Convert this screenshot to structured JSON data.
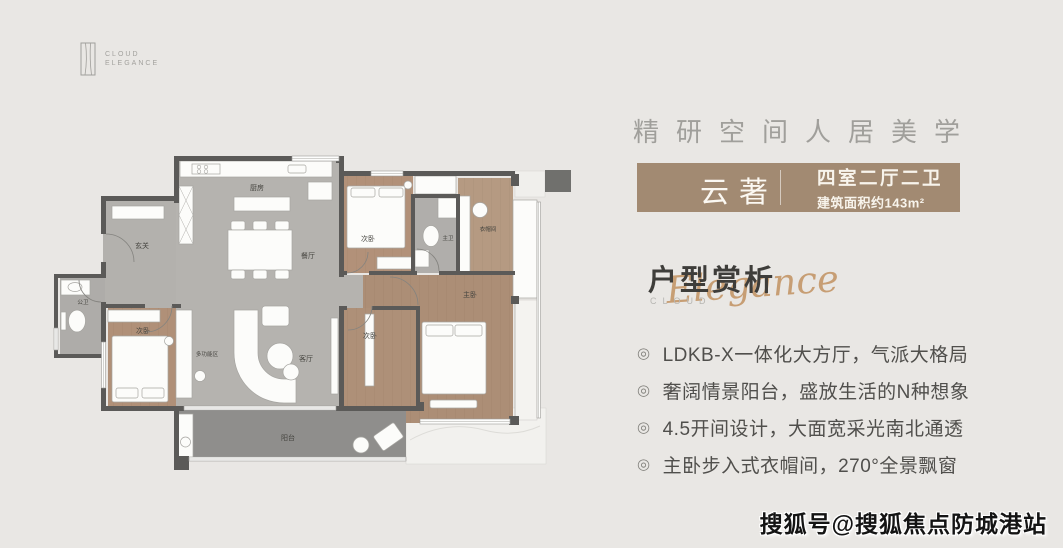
{
  "logo": {
    "line1": "CLOUD",
    "line2": "ELEGANCE"
  },
  "tagline": "精研空间人居美学",
  "badge": {
    "name": "云著",
    "layout": "四室二厅二卫",
    "area": "建筑面积约143m²",
    "bg_color": "#a28a72"
  },
  "section": {
    "title": "户型赏析",
    "eyebrow": "CLOUD",
    "script": "Elegance",
    "script_color": "#c79e74"
  },
  "bullet_icon": "◎",
  "features": [
    "LDKB-X一体化大方厅，气派大格局",
    "奢阔情景阳台，盛放生活的N种想象",
    "4.5开间设计，大面宽采光南北通透",
    "主卧步入式衣帽间，270°全景飘窗"
  ],
  "plan": {
    "rooms": {
      "entry": "玄关",
      "kitchen": "厨房",
      "dining": "餐厅",
      "living": "客厅",
      "multi": "多功能区",
      "balcony": "阳台",
      "bed_top": "次卧",
      "bed_left": "次卧",
      "bed_right": "次卧",
      "master": "主卧",
      "bath_public": "公卫",
      "bath_master": "主卫",
      "cloak": "衣帽间"
    }
  },
  "watermark": "搜狐号@搜狐焦点防城港站"
}
